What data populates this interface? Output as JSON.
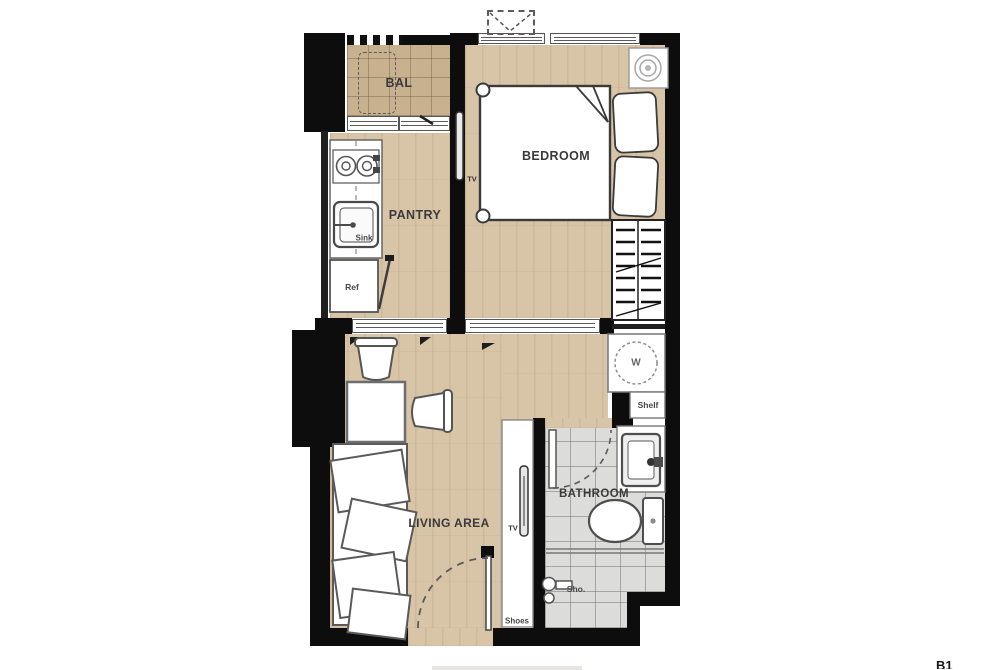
{
  "floorplan": {
    "rooms": [
      {
        "id": "balcony",
        "label": "BAL"
      },
      {
        "id": "pantry",
        "label": "PANTRY"
      },
      {
        "id": "bedroom",
        "label": "BEDROOM"
      },
      {
        "id": "living-area",
        "label": "LIVING AREA"
      },
      {
        "id": "bathroom",
        "label": "BATHROOM"
      }
    ],
    "fixtures": {
      "sink": "Sink",
      "refrigerator": "Ref",
      "tv_bedroom": "TV",
      "tv_living": "TV",
      "washing_machine": "W",
      "shelf": "Shelf",
      "shower": "Sho.",
      "shoes_cabinet": "Shoes"
    },
    "corner_mark": "B1",
    "colors": {
      "wall": "#0d0d0d",
      "wood_floor": "#d8c5a7",
      "balcony_tile": "#c7b18f",
      "bathroom_tile": "#dcdcda",
      "furniture_outline": "#555555"
    }
  }
}
